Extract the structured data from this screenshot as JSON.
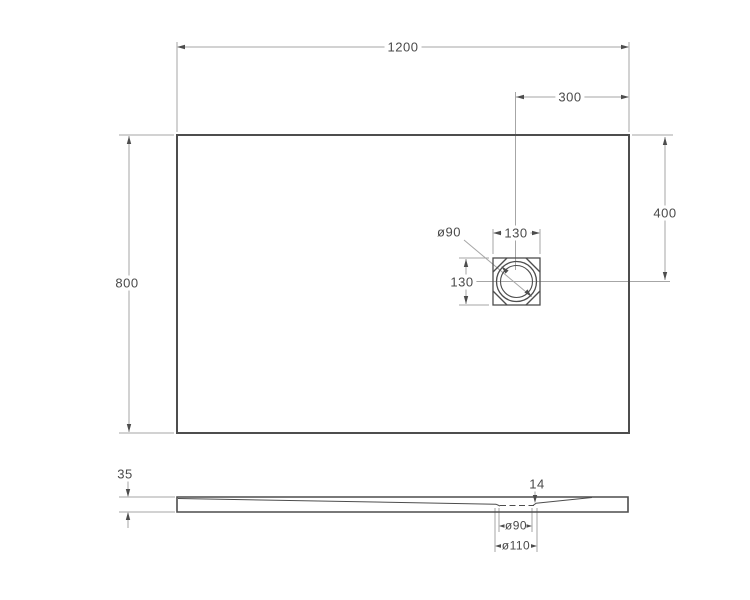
{
  "colors": {
    "outline": "#4d4d4d",
    "dimension_lines": "#a6a6a6",
    "text": "#4a4a4a",
    "background": "#ffffff"
  },
  "top_view": {
    "width": "1200",
    "height": "800",
    "drain_offset_from_right": "300",
    "drain_offset_from_top": "400",
    "drain_box_width": "130",
    "drain_box_height": "130",
    "drain_diameter": "ø90"
  },
  "side_view": {
    "edge_thickness": "35",
    "drain_point_thickness": "14",
    "drain_hole_diameter": "ø90",
    "drain_recess_diameter": "ø110"
  }
}
